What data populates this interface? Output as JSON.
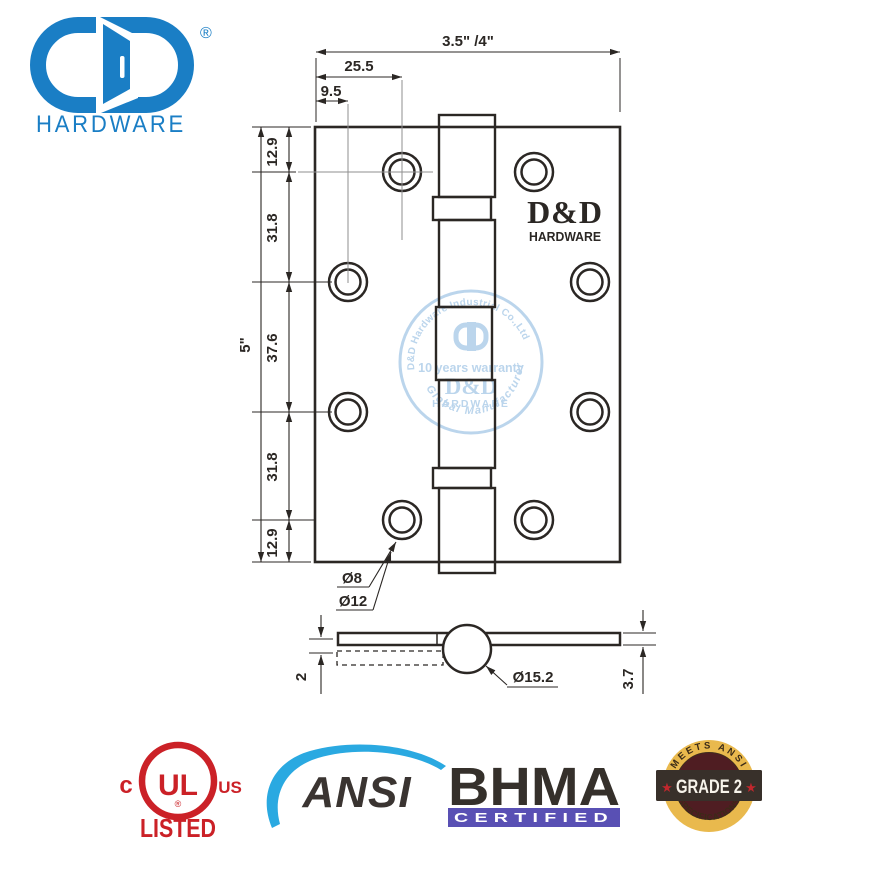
{
  "colors": {
    "brand_blue": "#1a7ec5",
    "line": "#2b2724",
    "centerline": "#8f8f8f",
    "stamp": "#abcbe8",
    "ul_red": "#cb2127",
    "ansi_blue": "#2aa9e1",
    "ansi_text": "#3a3431",
    "bhma_text": "#35302b",
    "bhma_bar": "#5950b4",
    "grade_ring": "#e9b94d",
    "grade_inner": "#4f1d22",
    "grade_banner": "#38302a",
    "grade_star": "#c1272d",
    "grade_arc_text": "#3b2b17",
    "grade_label_text": "#f7f3ea"
  },
  "logo": {
    "registered": "®",
    "wordmark": "HARDWARE"
  },
  "front_view": {
    "brand": "D&D",
    "brand_sub": "HARDWARE",
    "dims": {
      "overall_width": "3.5\" /4\"",
      "hole_offset_inner": "25.5",
      "hole_offset_outer": "9.5",
      "overall_height": "5\"",
      "segments": [
        "12.9",
        "31.8",
        "37.6",
        "31.8",
        "12.9"
      ],
      "hole_inner_dia": "Ø8",
      "hole_outer_dia": "Ø12"
    }
  },
  "section_view": {
    "dims": {
      "barrel_dia": "Ø15.2",
      "leaf_gap": "2",
      "leaf_thickness": "3.7"
    }
  },
  "watermark": {
    "arc_top": "D&D Hardware Industrial Co.,Ltd",
    "tagline": "10 years warranty",
    "brand": "D&D",
    "brand_sub": "HARDWARE",
    "arc_bottom": "Global Manufacturer"
  },
  "certifications": {
    "ul": {
      "prefix": "c",
      "mark": "UL",
      "suffix": "US",
      "label": "LISTED",
      "registered": "®"
    },
    "ansi": {
      "label": "ANSI"
    },
    "bhma": {
      "label": "BHMA",
      "sub_label": "CERTIFIED"
    },
    "grade": {
      "arc_top": "MEETS ANSI",
      "label": "GRADE 2",
      "arc_bottom": "SPECIFICATIONS",
      "star_left": "★",
      "star_right": "★"
    }
  }
}
